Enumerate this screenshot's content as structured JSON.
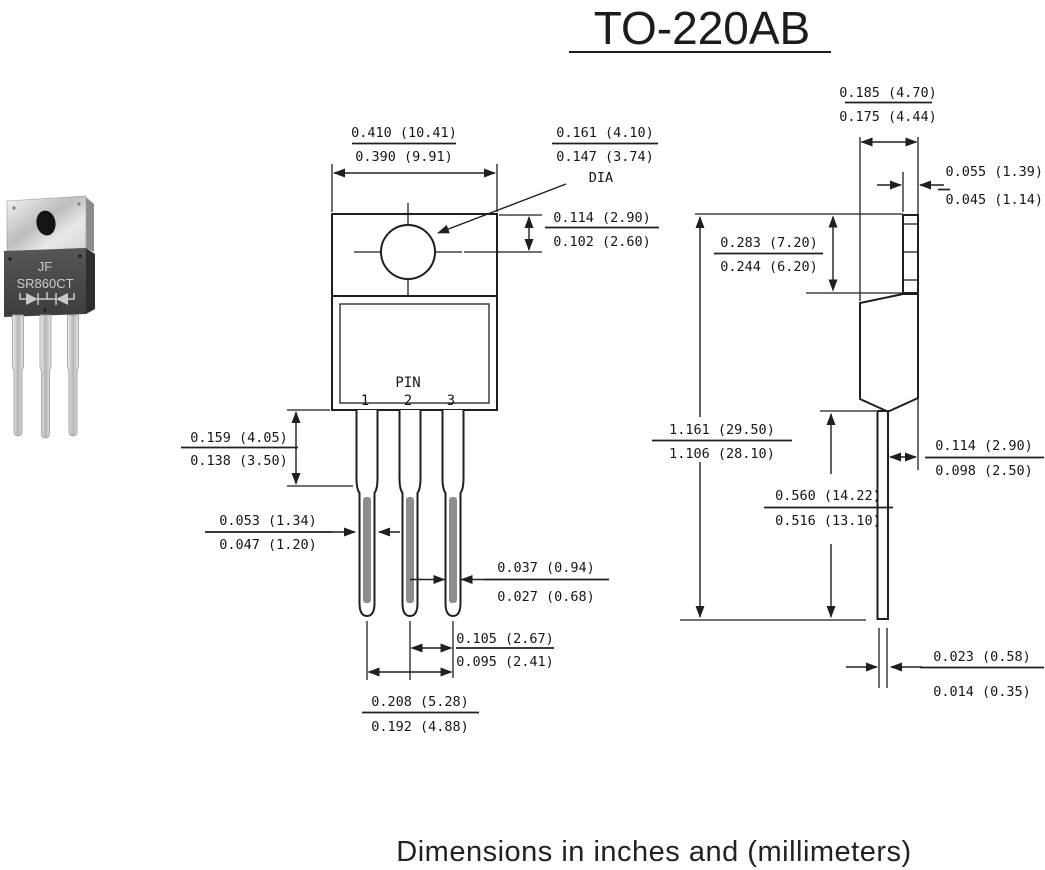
{
  "title": "TO-220AB",
  "caption": "Dimensions in inches and (millimeters)",
  "photo": {
    "brand": "JF",
    "part": "SR860CT"
  },
  "front_view": {
    "pin_label": "PIN",
    "pin_numbers": [
      "1",
      "2",
      "3"
    ],
    "dims": {
      "body_width": {
        "max": "0.410 (10.41)",
        "min": "0.390 (9.91)"
      },
      "hole_dia": {
        "max": "0.161 (4.10)",
        "min": "0.147 (3.74)",
        "suffix": "DIA"
      },
      "hole_center": {
        "max": "0.114 (2.90)",
        "min": "0.102 (2.60)"
      },
      "lead_shoulder": {
        "max": "0.159 (4.05)",
        "min": "0.138 (3.50)"
      },
      "lead_wide": {
        "max": "0.053 (1.34)",
        "min": "0.047 (1.20)"
      },
      "lead_narrow": {
        "max": "0.037 (0.94)",
        "min": "0.027 (0.68)"
      },
      "lead_pitch": {
        "max": "0.105 (2.67)",
        "min": "0.095 (2.41)"
      },
      "lead_span": {
        "max": "0.208 (5.28)",
        "min": "0.192 (4.88)"
      }
    }
  },
  "side_view": {
    "dims": {
      "tab_depth": {
        "max": "0.185 (4.70)",
        "min": "0.175 (4.44)"
      },
      "tab_thickness": {
        "max": "0.055 (1.39)",
        "min": "0.045 (1.14)"
      },
      "tab_height": {
        "max": "0.283 (7.20)",
        "min": "0.244 (6.20)"
      },
      "overall_height": {
        "max": "1.161 (29.50)",
        "min": "1.106 (28.10)"
      },
      "lead_length": {
        "max": "0.560 (14.22)",
        "min": "0.516 (13.10)"
      },
      "body_offset": {
        "max": "0.114 (2.90)",
        "min": "0.098 (2.50)"
      },
      "lead_thickness": {
        "max": "0.023 (0.58)",
        "min": "0.014 (0.35)"
      }
    }
  }
}
